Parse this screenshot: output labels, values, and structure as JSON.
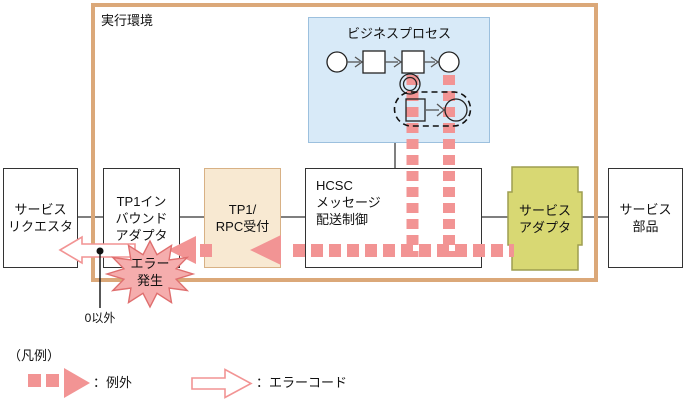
{
  "frame": {
    "label": "実行環境"
  },
  "business_process": {
    "title": "ビジネスプロセス"
  },
  "boxes": {
    "service_requester": {
      "line1": "サービス",
      "line2": "リクエスタ"
    },
    "tp1_inbound_adapter": {
      "line1": "TP1イン",
      "line2": "バウンド",
      "line3": "アダプタ"
    },
    "tp1_rpc_reception": {
      "line1": "TP1/",
      "line2": "RPC受付"
    },
    "hcsc_message_control": {
      "line1": "HCSC",
      "line2": "メッセージ",
      "line3": "配送制御"
    },
    "service_adapter": {
      "line1": "サービス",
      "line2": "アダプタ"
    },
    "service_component": {
      "line1": "サービス",
      "line2": "部品"
    }
  },
  "error_burst": {
    "line1": "エラー",
    "line2": "発生"
  },
  "return_value_label": "0以外",
  "legend": {
    "title": "（凡例）",
    "items": [
      {
        "name": "exception",
        "label": "：例外"
      },
      {
        "name": "error_code",
        "label": "：エラーコード"
      }
    ]
  },
  "colors": {
    "frame": "#DBA879",
    "bp_fill": "#D8EAF8",
    "bp_border": "#9CC0DE",
    "box_border": "#333333",
    "rpc_fill": "#F8E9D2",
    "rpc_border": "#D8B185",
    "adapter_fill": "#D8D873",
    "adapter_border": "#9E9E50",
    "pink": "#F29494",
    "burst_fill": "#F5ADAD",
    "burst_border": "#DF6F6F",
    "connector": "#555555",
    "shape_stroke": "#222222"
  }
}
